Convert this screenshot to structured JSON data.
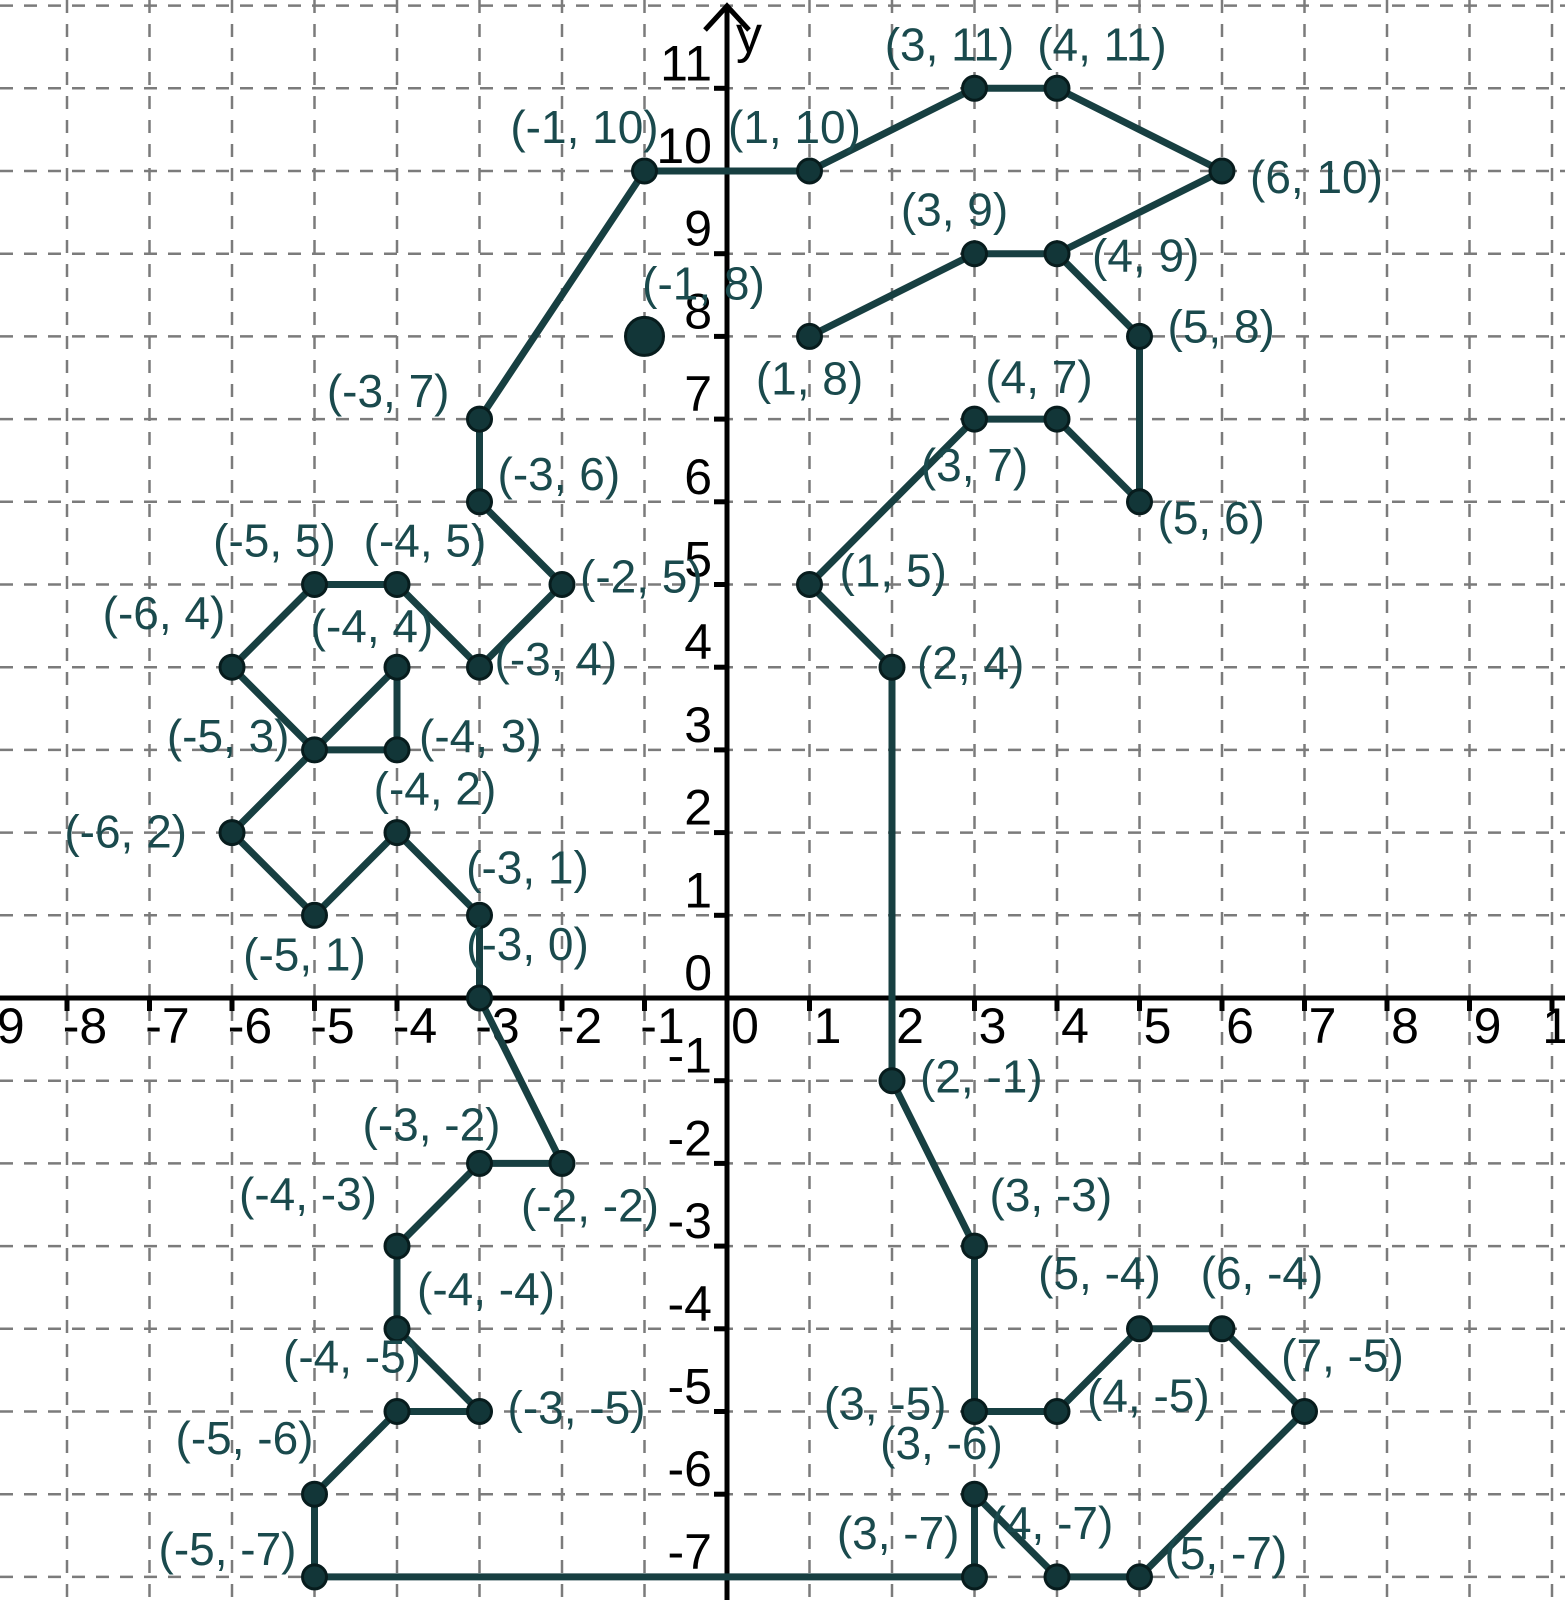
{
  "chart_data": {
    "type": "scatter",
    "title": "",
    "description": "Connect-the-dots coordinate plane picture (seahorse outline) with every vertex labeled",
    "axes": {
      "x_label": "",
      "y_label": "y",
      "xlim": [
        -9,
        10
      ],
      "ylim": [
        -7,
        12
      ],
      "grid": "dashed",
      "x_tick_labels": [
        -9,
        -8,
        -7,
        -6,
        -5,
        -4,
        -3,
        -2,
        -1,
        0,
        1,
        2,
        3,
        4,
        5,
        6,
        7,
        8,
        9,
        10
      ],
      "y_tick_labels": [
        11,
        10,
        9,
        8,
        7,
        6,
        5,
        4,
        3,
        2,
        1,
        0,
        -1,
        -2,
        -3,
        -4,
        -5,
        -6,
        -7
      ]
    },
    "colors": {
      "shape_line": "#173f41",
      "point_fill": "#123638",
      "point_stroke": "#071c1d",
      "label_text": "#1a4a4d",
      "axis": "#000000",
      "grid_line": "#7b7b7b",
      "background": "#ffffff"
    },
    "path": [
      [
        1,
        8
      ],
      [
        3,
        9
      ],
      [
        4,
        9
      ],
      [
        5,
        8
      ],
      [
        5,
        6
      ],
      [
        4,
        7
      ],
      [
        3,
        7
      ],
      [
        1,
        5
      ],
      [
        2,
        4
      ],
      [
        2,
        -1
      ],
      [
        3,
        -3
      ],
      [
        3,
        -5
      ],
      [
        4,
        -5
      ],
      [
        5,
        -4
      ],
      [
        6,
        -4
      ],
      [
        7,
        -5
      ],
      [
        5,
        -7
      ],
      [
        4,
        -7
      ],
      [
        3,
        -6
      ],
      [
        3,
        -7
      ],
      [
        -5,
        -7
      ],
      [
        -5,
        -6
      ],
      [
        -4,
        -5
      ],
      [
        -3,
        -5
      ],
      [
        -4,
        -4
      ],
      [
        -4,
        -3
      ],
      [
        -3,
        -2
      ],
      [
        -2,
        -2
      ],
      [
        -3,
        0
      ],
      [
        -3,
        1
      ],
      [
        -4,
        2
      ],
      [
        -5,
        1
      ],
      [
        -6,
        2
      ],
      [
        -5,
        3
      ],
      [
        -4,
        4
      ],
      [
        -4,
        3
      ],
      [
        -5,
        3
      ],
      [
        -6,
        4
      ],
      [
        -5,
        5
      ],
      [
        -4,
        5
      ],
      [
        -3,
        4
      ],
      [
        -2,
        5
      ],
      [
        -3,
        6
      ],
      [
        -3,
        7
      ],
      [
        -1,
        10
      ],
      [
        1,
        10
      ],
      [
        3,
        11
      ],
      [
        4,
        11
      ],
      [
        6,
        10
      ],
      [
        4,
        9
      ]
    ],
    "points": [
      {
        "x": 3,
        "y": 11,
        "label": "(3, 11)",
        "anchor": "middle",
        "dx": -25,
        "dy": -28
      },
      {
        "x": 4,
        "y": 11,
        "label": "(4, 11)",
        "anchor": "middle",
        "dx": 45,
        "dy": -28
      },
      {
        "x": -1,
        "y": 10,
        "label": "(-1, 10)",
        "anchor": "middle",
        "dx": -60,
        "dy": -28
      },
      {
        "x": 1,
        "y": 10,
        "label": "(1, 10)",
        "anchor": "middle",
        "dx": -15,
        "dy": -28
      },
      {
        "x": 6,
        "y": 10,
        "label": "(6, 10)",
        "anchor": "start",
        "dx": 28,
        "dy": 22
      },
      {
        "x": 3,
        "y": 9,
        "label": "(3, 9)",
        "anchor": "middle",
        "dx": -20,
        "dy": -28
      },
      {
        "x": 4,
        "y": 9,
        "label": "(4, 9)",
        "anchor": "start",
        "dx": 35,
        "dy": 18
      },
      {
        "x": 5,
        "y": 8,
        "label": "(5, 8)",
        "anchor": "start",
        "dx": 28,
        "dy": 6
      },
      {
        "x": 1,
        "y": 8,
        "label": "(1, 8)",
        "anchor": "middle",
        "dx": 0,
        "dy": 58
      },
      {
        "x": 4,
        "y": 7,
        "label": "(4, 7)",
        "anchor": "middle",
        "dx": -18,
        "dy": -26
      },
      {
        "x": -3,
        "y": 7,
        "label": "(-3, 7)",
        "anchor": "end",
        "dx": -30,
        "dy": -12
      },
      {
        "x": 3,
        "y": 7,
        "label": "(3, 7)",
        "anchor": "middle",
        "dx": 0,
        "dy": 62
      },
      {
        "x": 5,
        "y": 6,
        "label": "(5, 6)",
        "anchor": "start",
        "dx": 18,
        "dy": 32
      },
      {
        "x": -3,
        "y": 6,
        "label": "(-3, 6)",
        "anchor": "start",
        "dx": 18,
        "dy": -12
      },
      {
        "x": -5,
        "y": 5,
        "label": "(-5, 5)",
        "anchor": "middle",
        "dx": -40,
        "dy": -28
      },
      {
        "x": -4,
        "y": 5,
        "label": "(-4, 5)",
        "anchor": "middle",
        "dx": 28,
        "dy": -28
      },
      {
        "x": -2,
        "y": 5,
        "label": "(-2, 5)",
        "anchor": "start",
        "dx": 18,
        "dy": 8
      },
      {
        "x": 1,
        "y": 5,
        "label": "(1, 5)",
        "anchor": "start",
        "dx": 30,
        "dy": 2
      },
      {
        "x": -6,
        "y": 4,
        "label": "(-6, 4)",
        "anchor": "middle",
        "dx": -68,
        "dy": -38
      },
      {
        "x": -4,
        "y": 4,
        "label": "(-4, 4)",
        "anchor": "middle",
        "dx": -25,
        "dy": -25
      },
      {
        "x": -3,
        "y": 4,
        "label": "(-3, 4)",
        "anchor": "start",
        "dx": 15,
        "dy": 8
      },
      {
        "x": 2,
        "y": 4,
        "label": "(2, 4)",
        "anchor": "start",
        "dx": 25,
        "dy": 12
      },
      {
        "x": -5,
        "y": 3,
        "label": "(-5, 3)",
        "anchor": "end",
        "dx": -25,
        "dy": 2
      },
      {
        "x": -4,
        "y": 3,
        "label": "(-4, 3)",
        "anchor": "start",
        "dx": 22,
        "dy": 2
      },
      {
        "x": -4,
        "y": 2,
        "label": "(-4, 2)",
        "anchor": "middle",
        "dx": 38,
        "dy": -28
      },
      {
        "x": -6,
        "y": 2,
        "label": "(-6, 2)",
        "anchor": "end",
        "dx": -45,
        "dy": 15
      },
      {
        "x": -3,
        "y": 1,
        "label": "(-3, 1)",
        "anchor": "middle",
        "dx": 48,
        "dy": -32
      },
      {
        "x": -5,
        "y": 1,
        "label": "(-5, 1)",
        "anchor": "middle",
        "dx": -10,
        "dy": 55
      },
      {
        "x": -3,
        "y": 0,
        "label": "(-3, 0)",
        "anchor": "middle",
        "dx": 48,
        "dy": -38
      },
      {
        "x": 2,
        "y": -1,
        "label": "(2, -1)",
        "anchor": "start",
        "dx": 28,
        "dy": 12
      },
      {
        "x": -3,
        "y": -2,
        "label": "(-3, -2)",
        "anchor": "middle",
        "dx": -48,
        "dy": -23
      },
      {
        "x": -2,
        "y": -2,
        "label": "(-2, -2)",
        "anchor": "middle",
        "dx": 28,
        "dy": 58
      },
      {
        "x": -4,
        "y": -3,
        "label": "(-4, -3)",
        "anchor": "end",
        "dx": -20,
        "dy": -36
      },
      {
        "x": 3,
        "y": -3,
        "label": "(3, -3)",
        "anchor": "start",
        "dx": 15,
        "dy": -35
      },
      {
        "x": -4,
        "y": -4,
        "label": "(-4, -4)",
        "anchor": "start",
        "dx": 20,
        "dy": -24
      },
      {
        "x": 5,
        "y": -4,
        "label": "(5, -4)",
        "anchor": "middle",
        "dx": -40,
        "dy": -40
      },
      {
        "x": 6,
        "y": -4,
        "label": "(6, -4)",
        "anchor": "middle",
        "dx": 40,
        "dy": -40
      },
      {
        "x": -4,
        "y": -5,
        "label": "(-4, -5)",
        "anchor": "middle",
        "dx": -45,
        "dy": -39
      },
      {
        "x": -3,
        "y": -5,
        "label": "(-3, -5)",
        "anchor": "start",
        "dx": 28,
        "dy": 12
      },
      {
        "x": 3,
        "y": -5,
        "label": "(3, -5)",
        "anchor": "end",
        "dx": -28,
        "dy": 8
      },
      {
        "x": 4,
        "y": -5,
        "label": "(4, -5)",
        "anchor": "start",
        "dx": 30,
        "dy": 0
      },
      {
        "x": 7,
        "y": -5,
        "label": "(7, -5)",
        "anchor": "middle",
        "dx": 38,
        "dy": -40
      },
      {
        "x": -5,
        "y": -6,
        "label": "(-5, -6)",
        "anchor": "middle",
        "dx": -70,
        "dy": -40
      },
      {
        "x": 3,
        "y": -6,
        "label": "(3, -6)",
        "anchor": "middle",
        "dx": -33,
        "dy": -35
      },
      {
        "x": -5,
        "y": -7,
        "label": "(-5, -7)",
        "anchor": "end",
        "dx": -18,
        "dy": -12
      },
      {
        "x": 3,
        "y": -7,
        "label": "(3, -7)",
        "anchor": "end",
        "dx": -15,
        "dy": -28
      },
      {
        "x": 4,
        "y": -7,
        "label": "(4, -7)",
        "anchor": "middle",
        "dx": -5,
        "dy": -38
      },
      {
        "x": 5,
        "y": -7,
        "label": "(5, -7)",
        "anchor": "start",
        "dx": 25,
        "dy": -8
      }
    ],
    "eye_point": {
      "x": -1,
      "y": 8,
      "label": "(-1, 8)",
      "anchor": "middle",
      "dx": 59,
      "dy": -37,
      "r": 19
    }
  }
}
